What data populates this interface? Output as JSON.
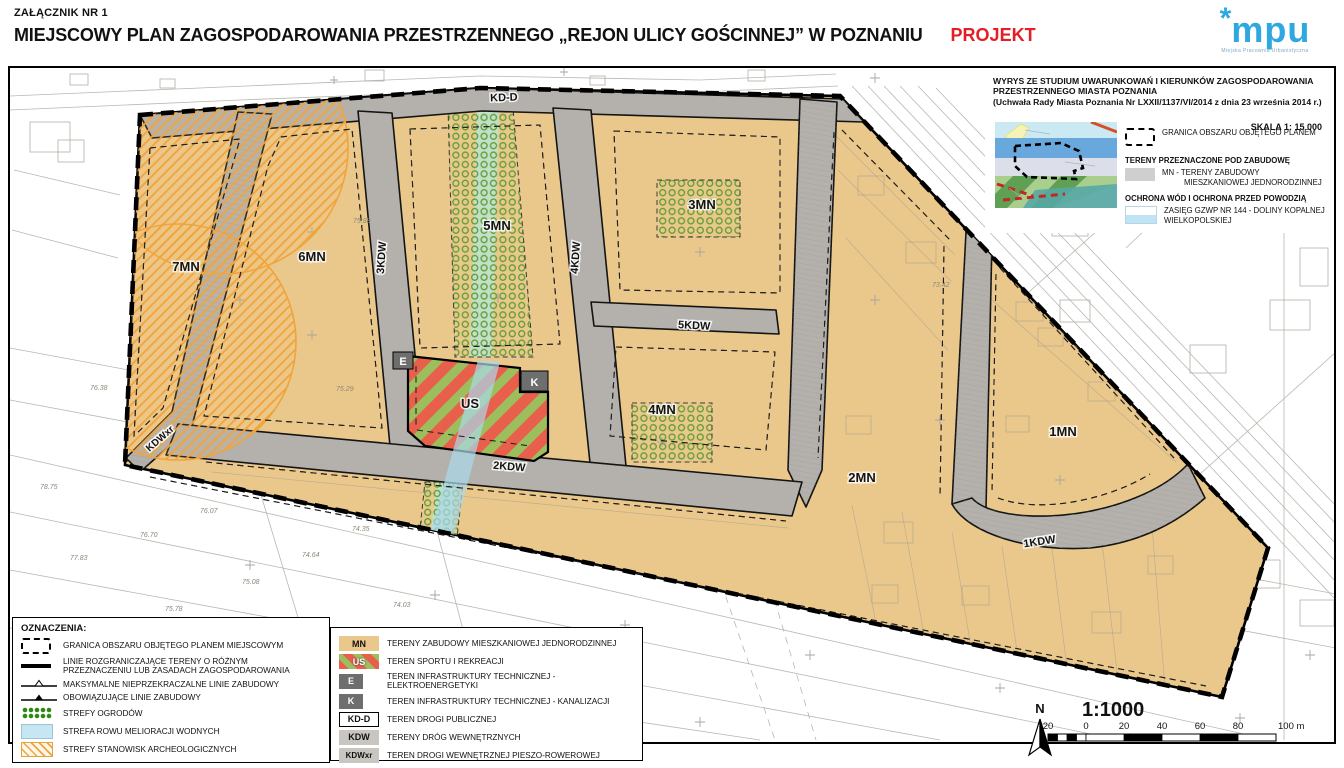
{
  "header": {
    "annex": "ZAŁĄCZNIK NR 1",
    "title": "MIEJSCOWY PLAN ZAGOSPODAROWANIA PRZESTRZENNEGO „REJON ULICY GOŚCINNEJ” W POZNANIU",
    "status": "PROJEKT",
    "logo": {
      "asterisk": "*",
      "name": "mpu",
      "caption": "Miejska Pracownia Urbanistyczna"
    }
  },
  "map": {
    "zones": [
      {
        "label": "1MN"
      },
      {
        "label": "2MN"
      },
      {
        "label": "3MN"
      },
      {
        "label": "4MN"
      },
      {
        "label": "5MN"
      },
      {
        "label": "6MN"
      },
      {
        "label": "7MN"
      },
      {
        "label": "US"
      }
    ],
    "roads": [
      {
        "label": "KD-D"
      },
      {
        "label": "KDWxr"
      },
      {
        "label": "3KDW"
      },
      {
        "label": "4KDW"
      },
      {
        "label": "5KDW"
      },
      {
        "label": "2KDW"
      },
      {
        "label": "1KDW"
      }
    ],
    "badges": [
      {
        "label": "E"
      },
      {
        "label": "K"
      }
    ],
    "survey_marks": [
      {
        "t": "76.38"
      },
      {
        "t": "78.75"
      },
      {
        "t": "76.70"
      },
      {
        "t": "77.83"
      },
      {
        "t": "75.08"
      },
      {
        "t": "75.78"
      },
      {
        "t": "76.07"
      },
      {
        "t": "74.35"
      },
      {
        "t": "74.64"
      },
      {
        "t": "74.03"
      },
      {
        "t": "75.29"
      },
      {
        "t": "75.88"
      },
      {
        "t": "73.42"
      },
      {
        "t": "72.50"
      }
    ]
  },
  "inset": {
    "title1": "WYRYS ZE STUDIUM UWARUNKOWAŃ I KIERUNKÓW ZAGOSPODAROWANIA",
    "title2": "PRZESTRZENNEGO MIASTA POZNANIA",
    "title3": "(Uchwała Rady Miasta Poznania Nr LXXII/1137/VI/2014  z dnia 23 września 2014 r.)",
    "scale": "SKALA 1: 15 000",
    "granica": "GRANICA OBSZARU OBJĘTEGO PLANEM",
    "header_zabudowa": "TERENY PRZEZNACZONE POD ZABUDOWĘ",
    "mn_line1": "MN - TERENY ZABUDOWY",
    "mn_line2": "MIESZKANIOWEJ JEDNORODZINNEJ",
    "header_ochrona": "OCHRONA WÓD I OCHRONA PRZED POWODZIĄ",
    "gzwp_line1": "ZASIĘG  GZWP NR 144 - DOLINY KOPALNEJ",
    "gzwp_line2": "WIELKOPOLSKIEJ"
  },
  "legend_left": {
    "title": "OZNACZENIA:",
    "items": [
      {
        "label": "GRANICA OBSZARU OBJĘTEGO PLANEM MIEJSCOWYM"
      },
      {
        "label": "LINIE ROZGRANICZAJĄCE TERENY O RÓŻNYM PRZEZNACZENIU LUB ZASADACH ZAGOSPODAROWANIA"
      },
      {
        "label": "MAKSYMALNE NIEPRZEKRACZALNE LINIE ZABUDOWY"
      },
      {
        "label": "OBOWIĄZUJĄCE LINIE ZABUDOWY"
      },
      {
        "label": "STREFY OGRODÓW"
      },
      {
        "label": "STREFA ROWU MELIORACJI WODNYCH"
      },
      {
        "label": "STREFY STANOWISK ARCHEOLOGICZNYCH"
      }
    ]
  },
  "legend_right": {
    "items": [
      {
        "code": "MN",
        "label": "TERENY ZABUDOWY MIESZKANIOWEJ JEDNORODZINNEJ"
      },
      {
        "code": "US",
        "label": "TEREN SPORTU I REKREACJI"
      },
      {
        "code": "E",
        "label": "TEREN INFRASTRUKTURY TECHNICZNEJ - ELEKTROENERGETYKI"
      },
      {
        "code": "K",
        "label": "TEREN INFRASTRUKTURY TECHNICZNEJ - KANALIZACJI"
      },
      {
        "code": "KD-D",
        "label": "TEREN DROGI PUBLICZNEJ"
      },
      {
        "code": "KDW",
        "label": "TERENY DRÓG WEWNĘTRZNYCH"
      },
      {
        "code": "KDWxr",
        "label": "TEREN DROGI WEWNĘTRZNEJ PIESZO-ROWEROWEJ"
      }
    ]
  },
  "scalebar": {
    "north": "N",
    "ratio": "1:1000",
    "ticks": [
      "20",
      "0",
      "20",
      "40",
      "60",
      "80"
    ],
    "last": "100 m"
  },
  "colors": {
    "mn": "#EAC88C",
    "road": "#B4B1AD",
    "us_red": "#E8604C",
    "us_green": "#9CBE5C",
    "garden_green": "#5F9E33",
    "ditch_blue": "#A9D9E9",
    "ditch_teal": "#BFE0CC",
    "arch_orange": "#F0A43C",
    "status_red": "#E31E24",
    "logo_blue": "#2FA8DF",
    "badge_gray": "#6E6E6E"
  }
}
